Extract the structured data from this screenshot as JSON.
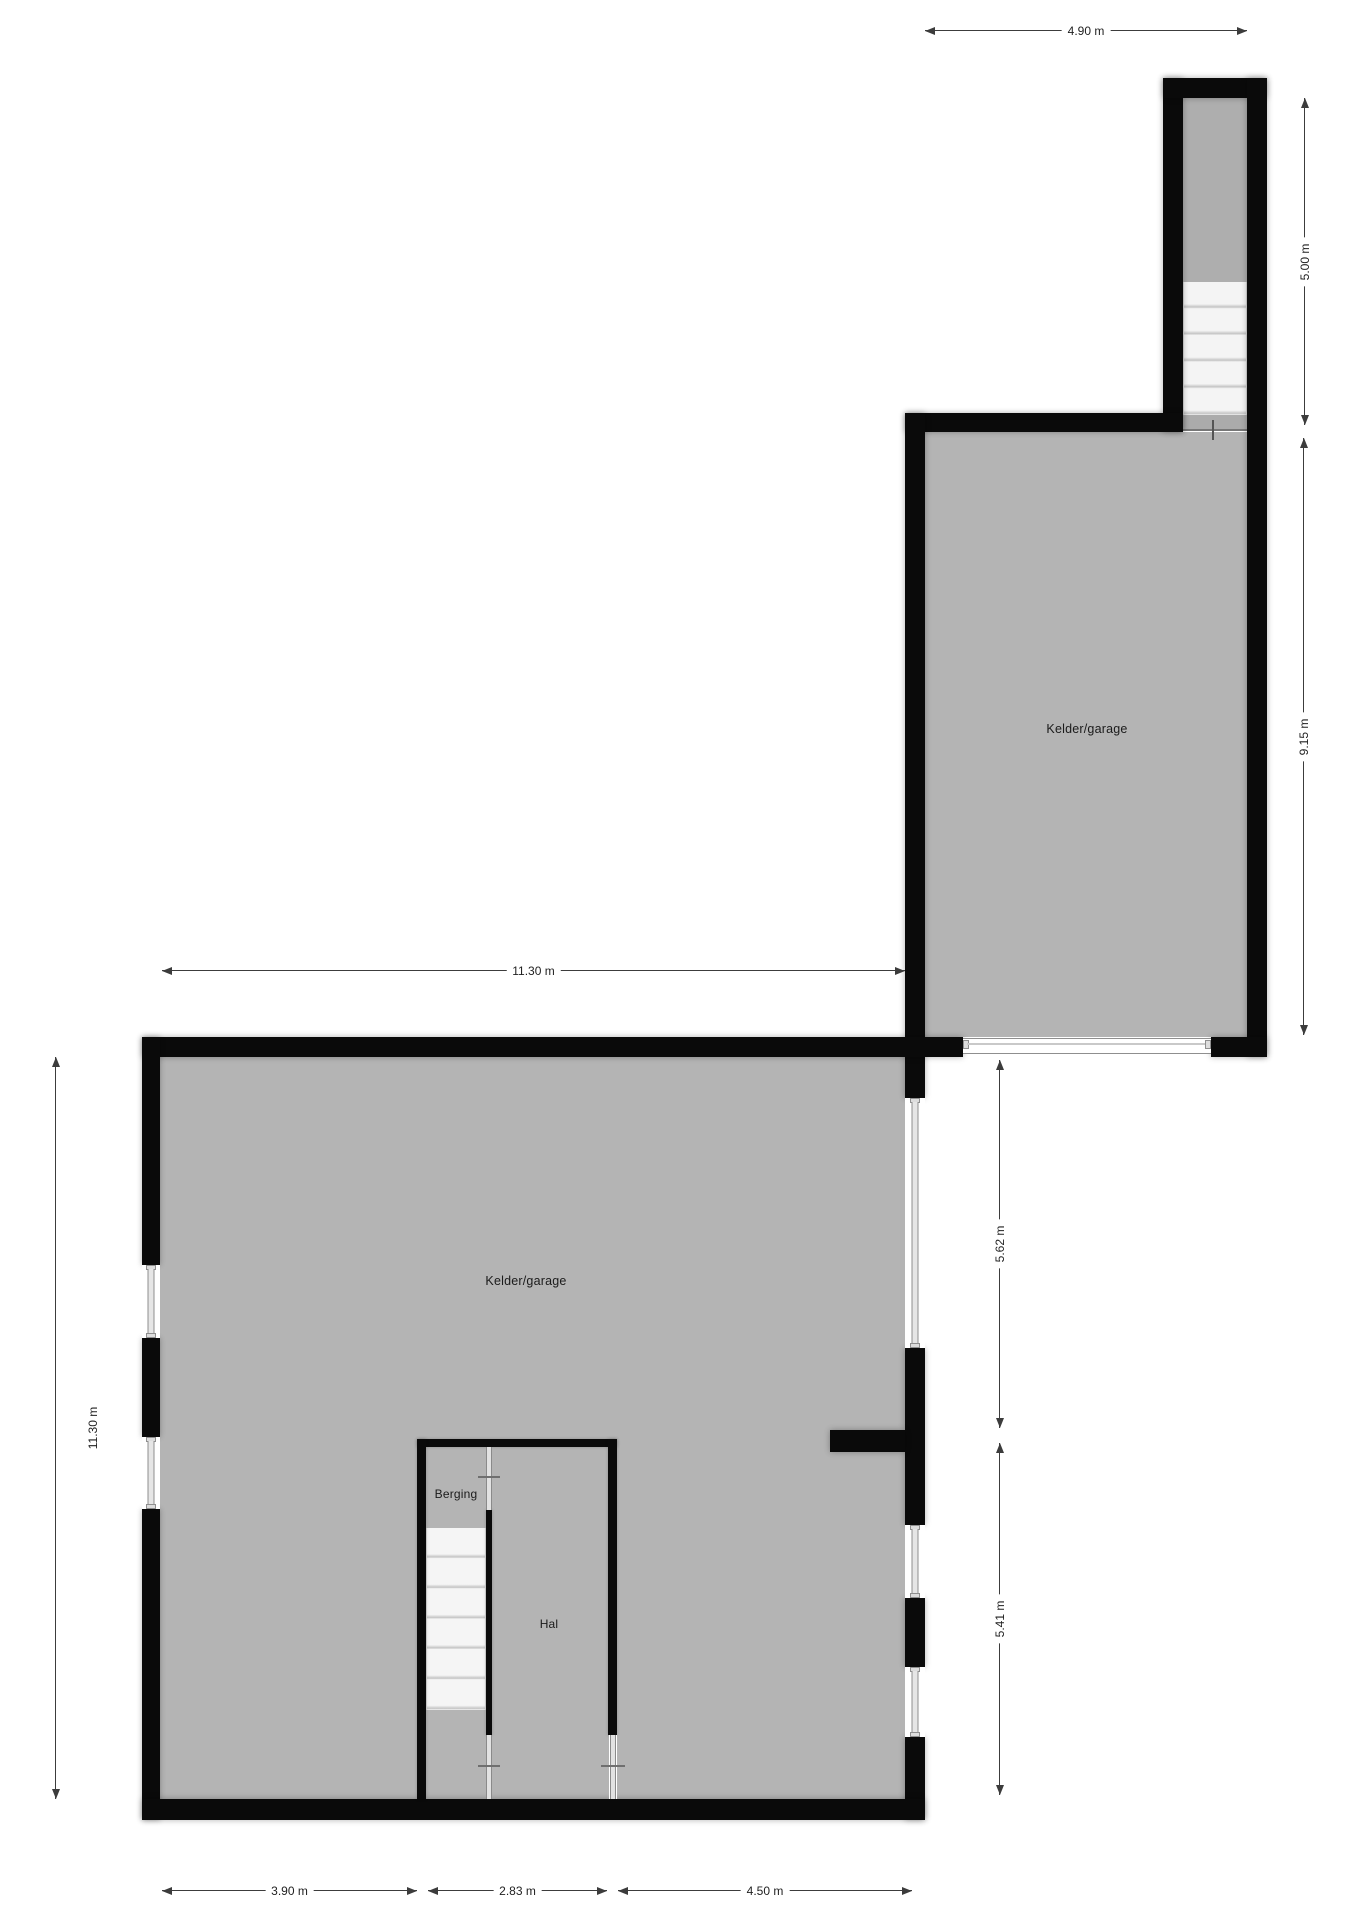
{
  "rooms": {
    "upper": {
      "label": "Kelder/garage"
    },
    "lower": {
      "label": "Kelder/garage"
    },
    "berging": {
      "label": "Berging"
    },
    "hal": {
      "label": "Hal"
    }
  },
  "dimensions": {
    "top_width": "4.90 m",
    "stairwell_height": "5.00 m",
    "upper_height": "9.15 m",
    "lower_width": "11.30 m",
    "lower_height": "11.30 m",
    "right_top": "5.62 m",
    "right_bottom": "5.41 m",
    "bottom_left": "3.90 m",
    "bottom_center": "2.83 m",
    "bottom_right": "4.50 m"
  },
  "colors": {
    "wall": "#0a0a0a",
    "floor": "#b4b4b4",
    "window": "#8f8f8f",
    "dim": "#3c3c3c",
    "text": "#1b1b1b"
  }
}
